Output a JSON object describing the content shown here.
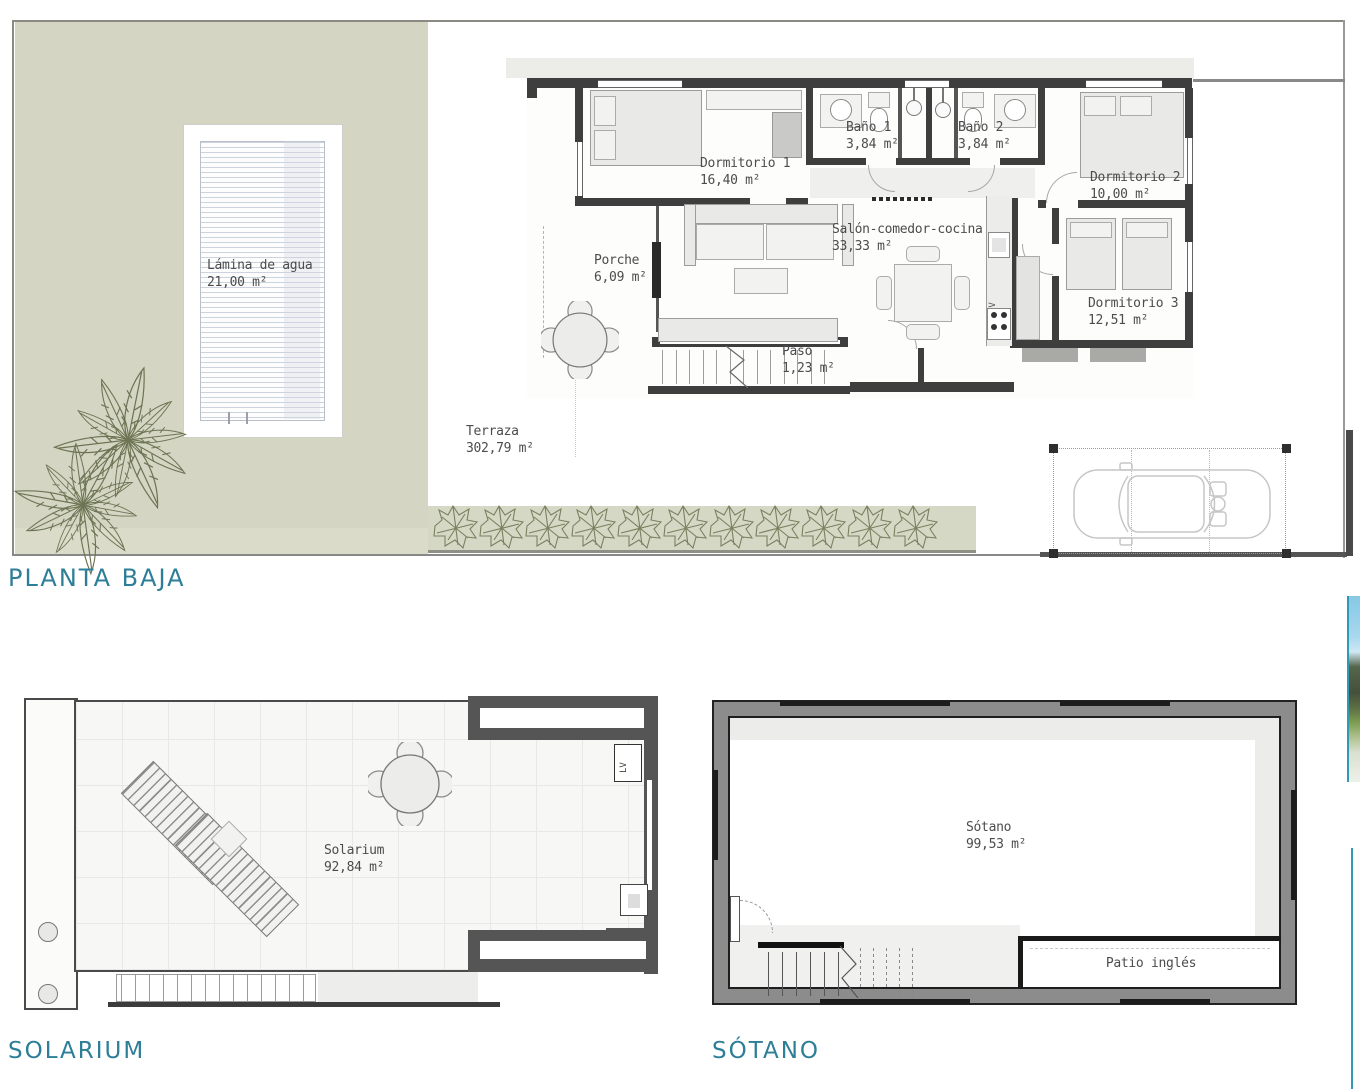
{
  "titles": {
    "planta_baja": "PLANTA BAJA",
    "solarium": "SOLARIUM",
    "sotano": "SÓTANO"
  },
  "rooms": {
    "lamina": {
      "name": "Lámina de agua",
      "area": "21,00 m²"
    },
    "dorm1": {
      "name": "Dormitorio 1",
      "area": "16,40 m²"
    },
    "bano1": {
      "name": "Baño 1",
      "area": "3,84 m²"
    },
    "bano2": {
      "name": "Baño 2",
      "area": "3,84 m²"
    },
    "dorm2": {
      "name": "Dormitorio 2",
      "area": "10,00 m²"
    },
    "salon": {
      "name": "Salón-comedor-cocina",
      "area": "33,33 m²"
    },
    "dorm3": {
      "name": "Dormitorio 3",
      "area": "12,51 m²"
    },
    "porche": {
      "name": "Porche",
      "area": "6,09 m²"
    },
    "paso": {
      "name": "Paso",
      "area": "1,23 m²"
    },
    "terraza": {
      "name": "Terraza",
      "area": "302,79 m²"
    },
    "solarium": {
      "name": "Solarium",
      "area": "92,84 m²"
    },
    "sotano": {
      "name": "Sótano",
      "area": "99,53 m²"
    },
    "patio": {
      "name": "Patio inglés",
      "area": ""
    }
  },
  "annotations": {
    "lv": "LV"
  },
  "colors": {
    "accent_teal": "#2d7e97",
    "terrain": "#d4d6c3",
    "wall_dark": "#3e3e3e",
    "sotano_wall": "#8c8c8c",
    "vegetation": "#6d7454"
  }
}
